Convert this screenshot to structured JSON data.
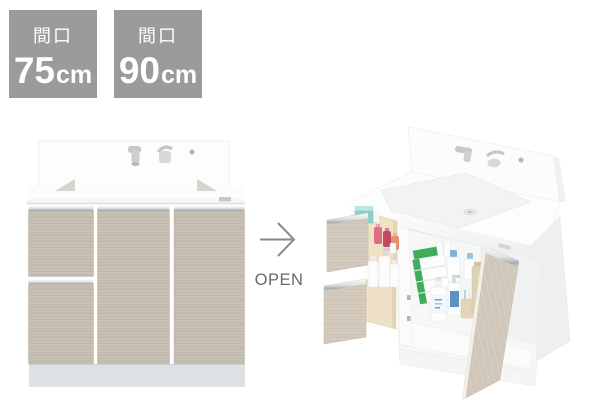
{
  "badges": [
    {
      "label": "間口",
      "value": "75",
      "unit": "cm"
    },
    {
      "label": "間口",
      "value": "90",
      "unit": "cm"
    }
  ],
  "transition": {
    "arrow_icon": "right-arrow-icon",
    "label": "OPEN"
  },
  "colors": {
    "background": "#ffffff",
    "badge_bg": "#9b9b9b",
    "badge_text": "#ffffff",
    "arrow": "#8a8a8a",
    "open_label": "#6a6a6a",
    "wood": "#c6bdb2",
    "wood_light": "#d2c9bc",
    "drawer_box": "#eee1c6",
    "metal": "#a8aeb2",
    "kick_plate": "#dde1e4",
    "teal_item": "#8ad2c8",
    "green_item": "#3fae5c",
    "blue_item": "#7fb1d8",
    "pink_item": "#df6d88"
  }
}
